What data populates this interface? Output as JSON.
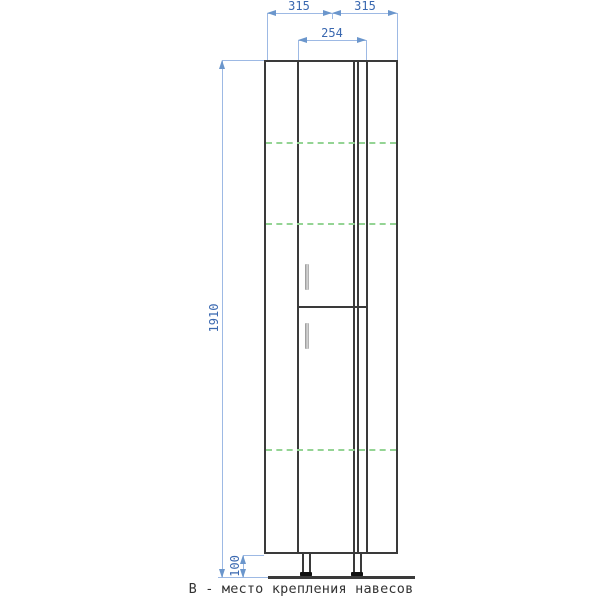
{
  "caption": "В - место крепления навесов",
  "dims": {
    "width_left": "315",
    "width_right": "315",
    "door_width": "254",
    "total_height": "1910",
    "leg_height": "100"
  },
  "guides": {
    "meaning": "hanger mounting positions (навесы)",
    "style": "green-dashed",
    "count": 3
  },
  "colors": {
    "outline": "#3a3a3a",
    "dim_line": "#9db9e4",
    "dim_arrow": "#6b96cc",
    "dim_text": "#3a68b0",
    "guide_green": "#94d494",
    "caption_text": "#333333",
    "background": "#ffffff"
  }
}
